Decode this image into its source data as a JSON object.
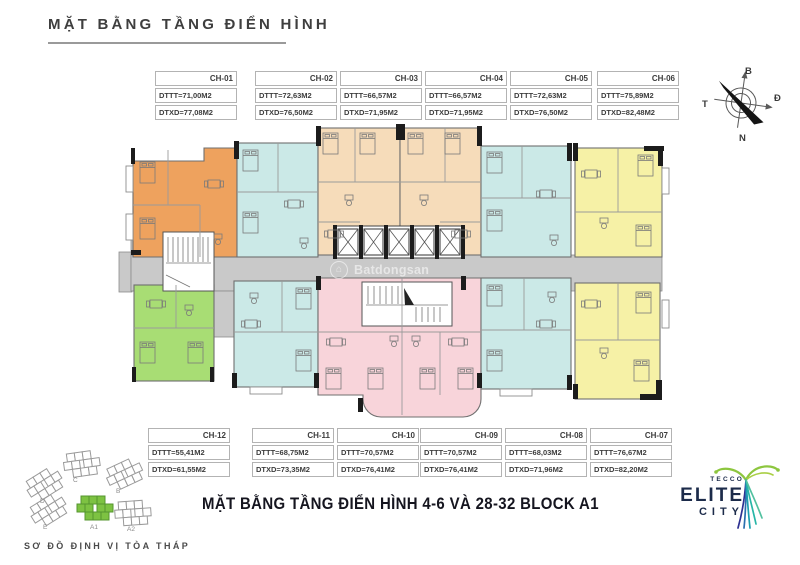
{
  "page": {
    "title": "MẶT BẰNG TẦNG ĐIỂN HÌNH",
    "subtitle": "MẶT BẰNG TẦNG ĐIỂN HÌNH 4-6 VÀ 28-32 BLOCK A1",
    "siteplan_caption": "SƠ ĐỒ ĐỊNH VỊ TÒA THÁP",
    "watermark": "Batdongsan"
  },
  "compass": {
    "north": "B",
    "east": "Đ",
    "south": "N",
    "west": "T"
  },
  "units_top": [
    {
      "id": "CH-01",
      "dttt": "DTTT=71,00M2",
      "dtxd": "DTXD=77,08M2",
      "color": "#eea25e"
    },
    {
      "id": "CH-02",
      "dttt": "DTTT=72,63M2",
      "dtxd": "DTXD=76,50M2",
      "color": "#cbe9e7"
    },
    {
      "id": "CH-03",
      "dttt": "DTTT=66,57M2",
      "dtxd": "DTXD=71,95M2",
      "color": "#f6dcba"
    },
    {
      "id": "CH-04",
      "dttt": "DTTT=66,57M2",
      "dtxd": "DTXD=71,95M2",
      "color": "#f6dcba"
    },
    {
      "id": "CH-05",
      "dttt": "DTTT=72,63M2",
      "dtxd": "DTXD=76,50M2",
      "color": "#cbe9e7"
    },
    {
      "id": "CH-06",
      "dttt": "DTTT=75,89M2",
      "dtxd": "DTXD=82,48M2",
      "color": "#f6f1a6"
    }
  ],
  "units_bottom": [
    {
      "id": "CH-12",
      "dttt": "DTTT=55,41M2",
      "dtxd": "DTXD=61,55M2",
      "color": "#a8dd74"
    },
    {
      "id": "CH-11",
      "dttt": "DTTT=68,75M2",
      "dtxd": "DTXD=73,35M2",
      "color": "#cbe9e7"
    },
    {
      "id": "CH-10",
      "dttt": "DTTT=70,57M2",
      "dtxd": "DTXD=76,41M2",
      "color": "#f8d4da"
    },
    {
      "id": "CH-09",
      "dttt": "DTTT=70,57M2",
      "dtxd": "DTXD=76,41M2",
      "color": "#f8d4da"
    },
    {
      "id": "CH-08",
      "dttt": "DTTT=68,03M2",
      "dtxd": "DTXD=71,96M2",
      "color": "#cbe9e7"
    },
    {
      "id": "CH-07",
      "dttt": "DTTT=76,67M2",
      "dtxd": "DTXD=82,20M2",
      "color": "#f6f1a6"
    }
  ],
  "colors": {
    "corridor": "#c9c9c9",
    "wall": "#1c1c1c",
    "siteplan_highlight": "#7dc242",
    "logo_navy": "#1c2b4a",
    "logo_leaf": "#8dc63f",
    "logo_trunk": "#2e3192"
  },
  "site_plan": {
    "buildings": [
      {
        "label": "D"
      },
      {
        "label": "C"
      },
      {
        "label": "B"
      },
      {
        "label": "E"
      },
      {
        "label": "A1"
      },
      {
        "label": "A2"
      }
    ]
  },
  "logo": {
    "brand": "TECCO",
    "line1": "ELITE",
    "line2": "CITY"
  }
}
